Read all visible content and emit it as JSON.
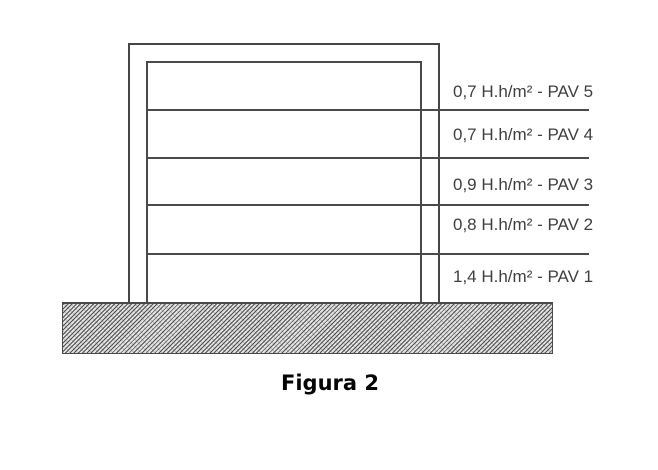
{
  "figure": {
    "caption": "Figura 2",
    "line_color": "#4a4a4a",
    "text_color": "#3f3f3f",
    "ground_pattern": "diagonal-hatch"
  },
  "building": {
    "type": "five-storey building section",
    "floors": [
      {
        "label": "0,7 H.h/m² - PAV 5",
        "value": "0,7",
        "unit": "H.h/m²",
        "name": "PAV 5"
      },
      {
        "label": "0,7 H.h/m² - PAV 4",
        "value": "0,7",
        "unit": "H.h/m²",
        "name": "PAV 4"
      },
      {
        "label": "0,9 H.h/m² - PAV 3",
        "value": "0,9",
        "unit": "H.h/m²",
        "name": "PAV 3"
      },
      {
        "label": "0,8 H.h/m² - PAV 2",
        "value": "0,8",
        "unit": "H.h/m²",
        "name": "PAV 2"
      },
      {
        "label": "1,4 H.h/m² - PAV 1",
        "value": "1,4",
        "unit": "H.h/m²",
        "name": "PAV 1"
      }
    ]
  }
}
